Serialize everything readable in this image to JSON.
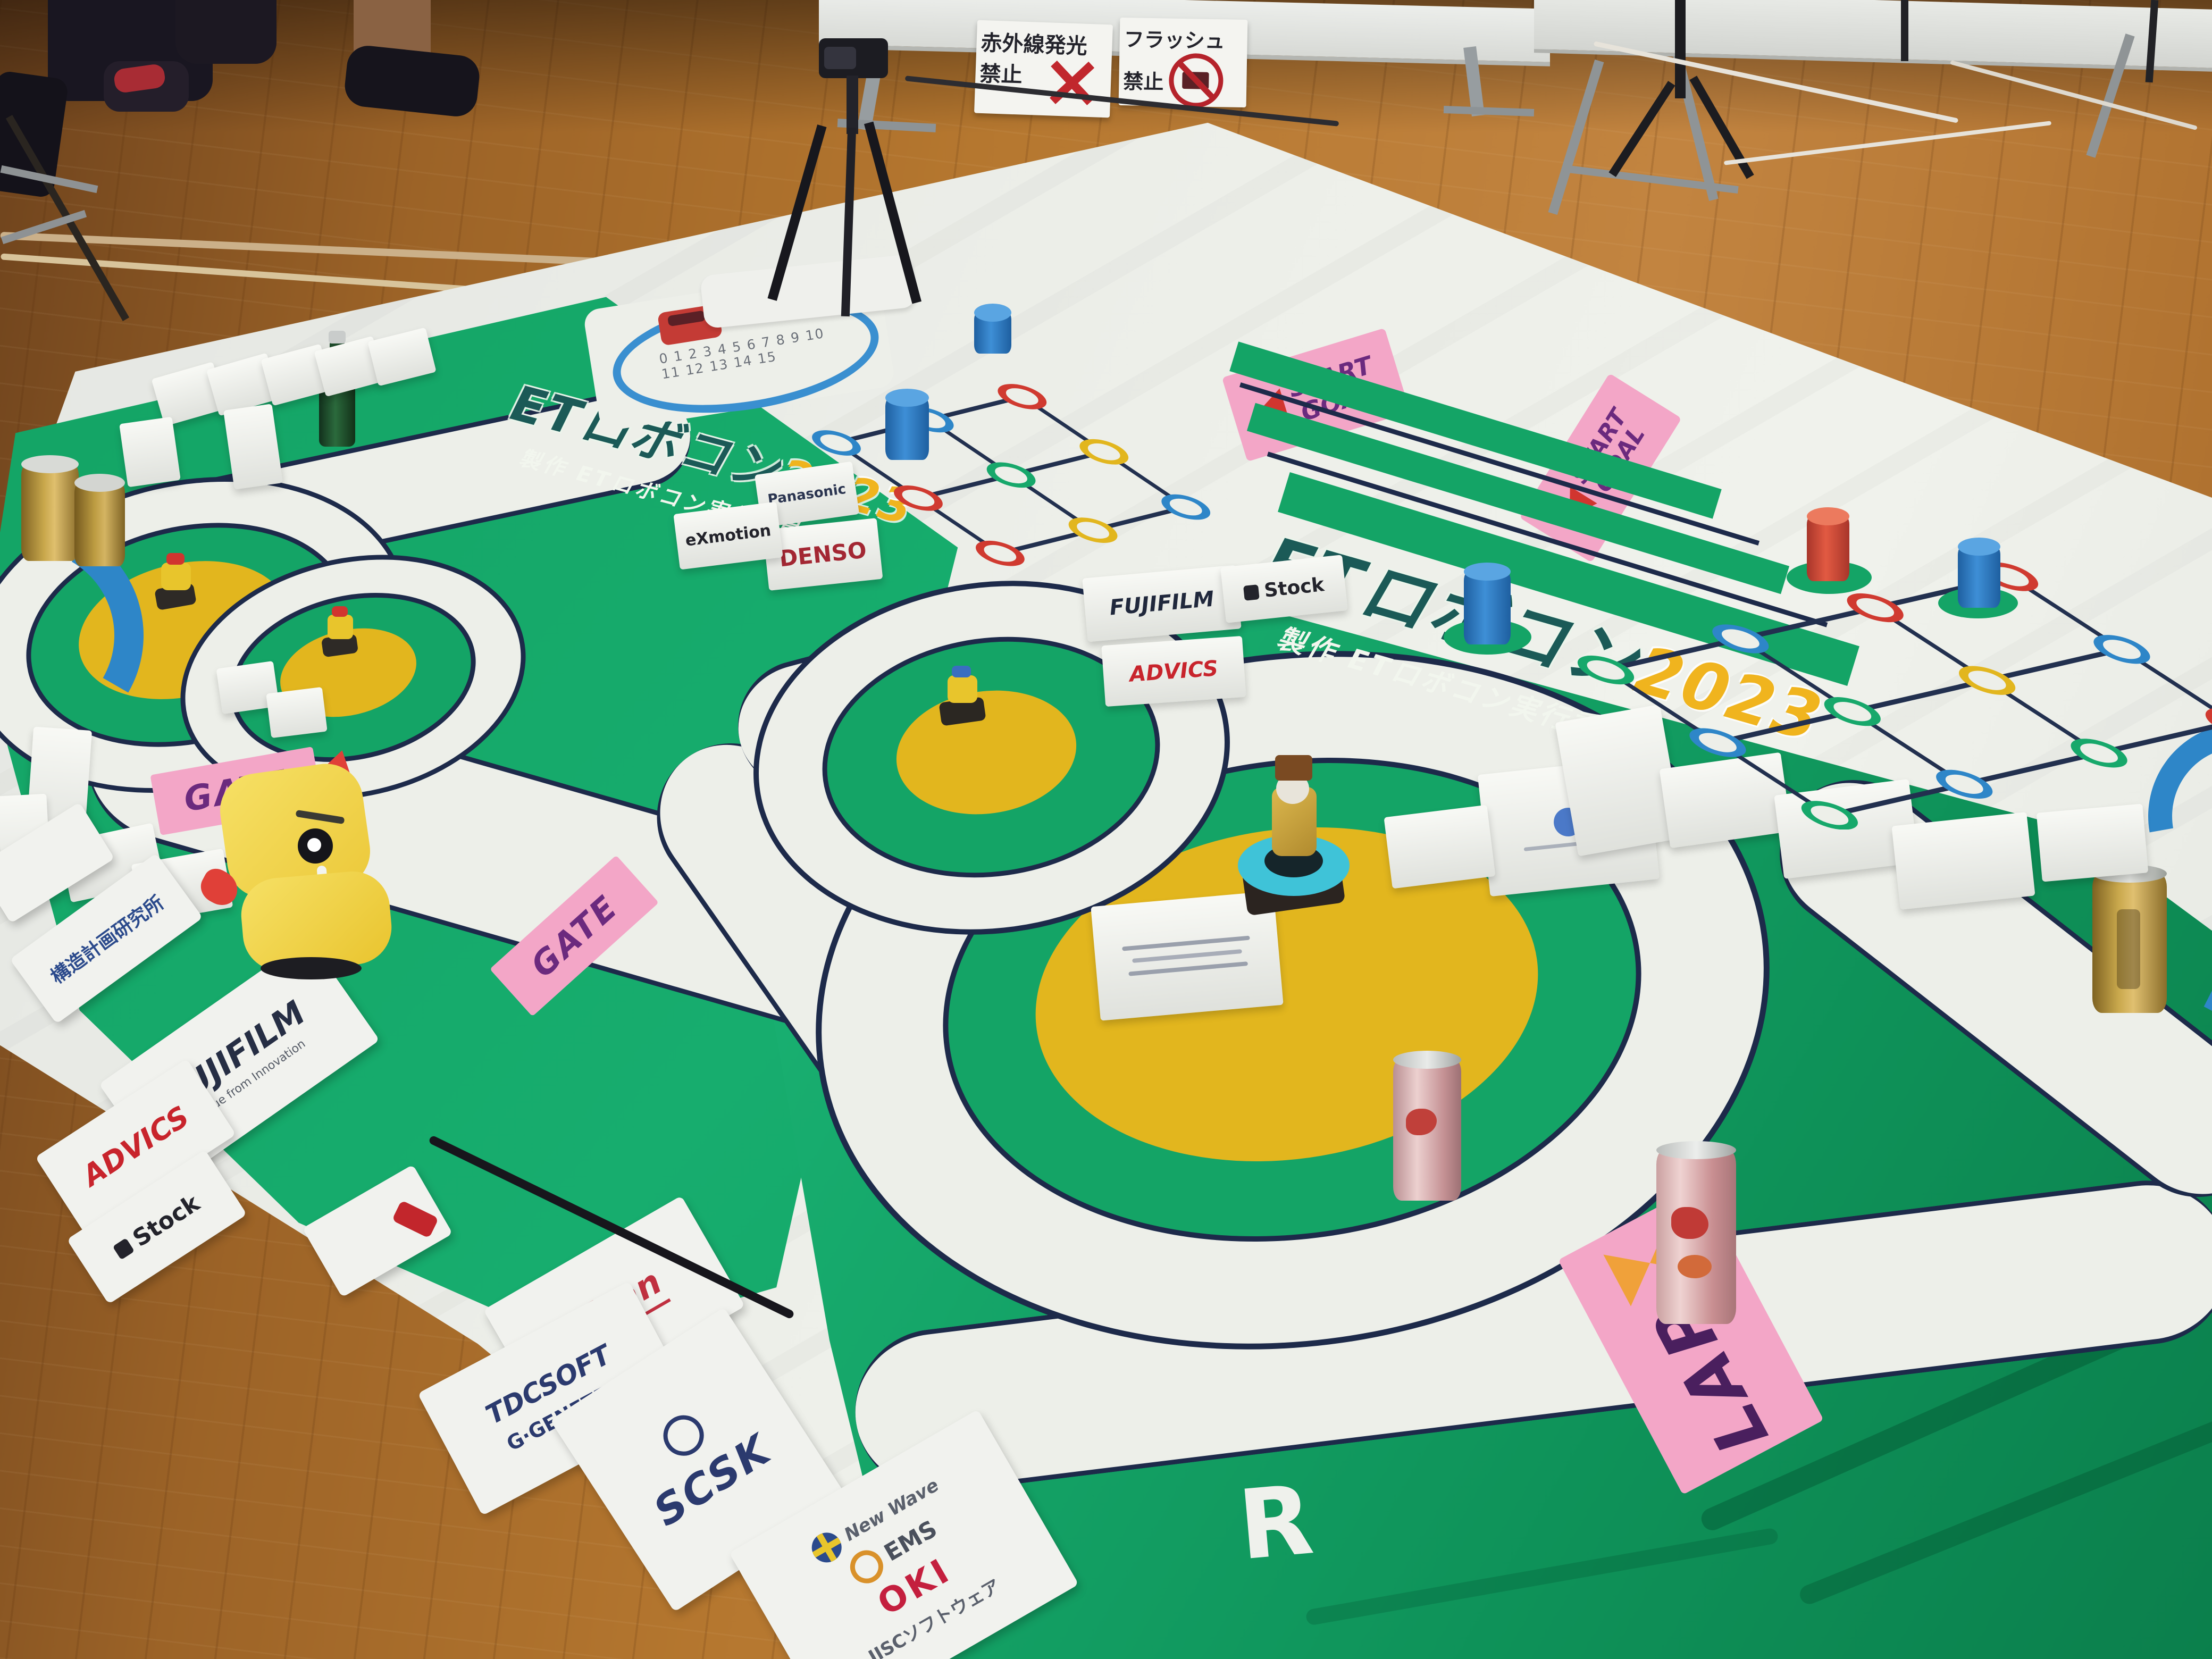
{
  "colors": {
    "floor_wood": "#b5772f",
    "mat_white": "#e9ebe7",
    "course_green": "#14a466",
    "line_navy": "#1d2a4a",
    "island_yellow": "#e2b61e",
    "sign_pink": "#f3a6c7",
    "label_purple": "#6b2a7e",
    "logo_teal": "#1b5a57",
    "logo_year_yellow": "#f0b41e",
    "track_blue": "#2e86c8",
    "warning_red": "#c1272d"
  },
  "warning_signs": {
    "no_infrared": {
      "line1": "赤外線発光",
      "line2": "禁止",
      "icon": "red-x-icon"
    },
    "no_flash": {
      "line1": "フラッシュ",
      "line2": "禁止",
      "icon": "no-flash-icon"
    }
  },
  "course": {
    "logo_title": "ETロボコン",
    "logo_year": "2023",
    "logo_subtitle": "製作 ETロボコン実行委員会",
    "gate_label": "GATE",
    "start_label": "START",
    "goal_label": "GOAL",
    "lap_label": "LAP",
    "section_label": "R",
    "lap_numbers": "0 1 2 3 4 5 6 7 8 9 10 11 12 13 14 15"
  },
  "tent_cards": {
    "panasonic": "Panasonic",
    "exmotion": "eXmotion",
    "denso": "DENSO",
    "fujifilm": "FUJIFILM",
    "advics": "ADVICS",
    "stock": "Stock"
  },
  "banners": {
    "kozo": "構造計画研究所",
    "fujifilm": "FUJIFILM",
    "fujifilm_tagline": "Value from Innovation",
    "advics": "ADVICS",
    "stock": "Stock",
    "aisan": "Aisan",
    "tdcsoft": "TDCSOFT",
    "genetec": "G·GENETEC",
    "scsk": "SCSK",
    "newwave": "New Wave",
    "ems": "EMS",
    "oki": "OKI",
    "jisc": "JISCソフトウェア"
  }
}
